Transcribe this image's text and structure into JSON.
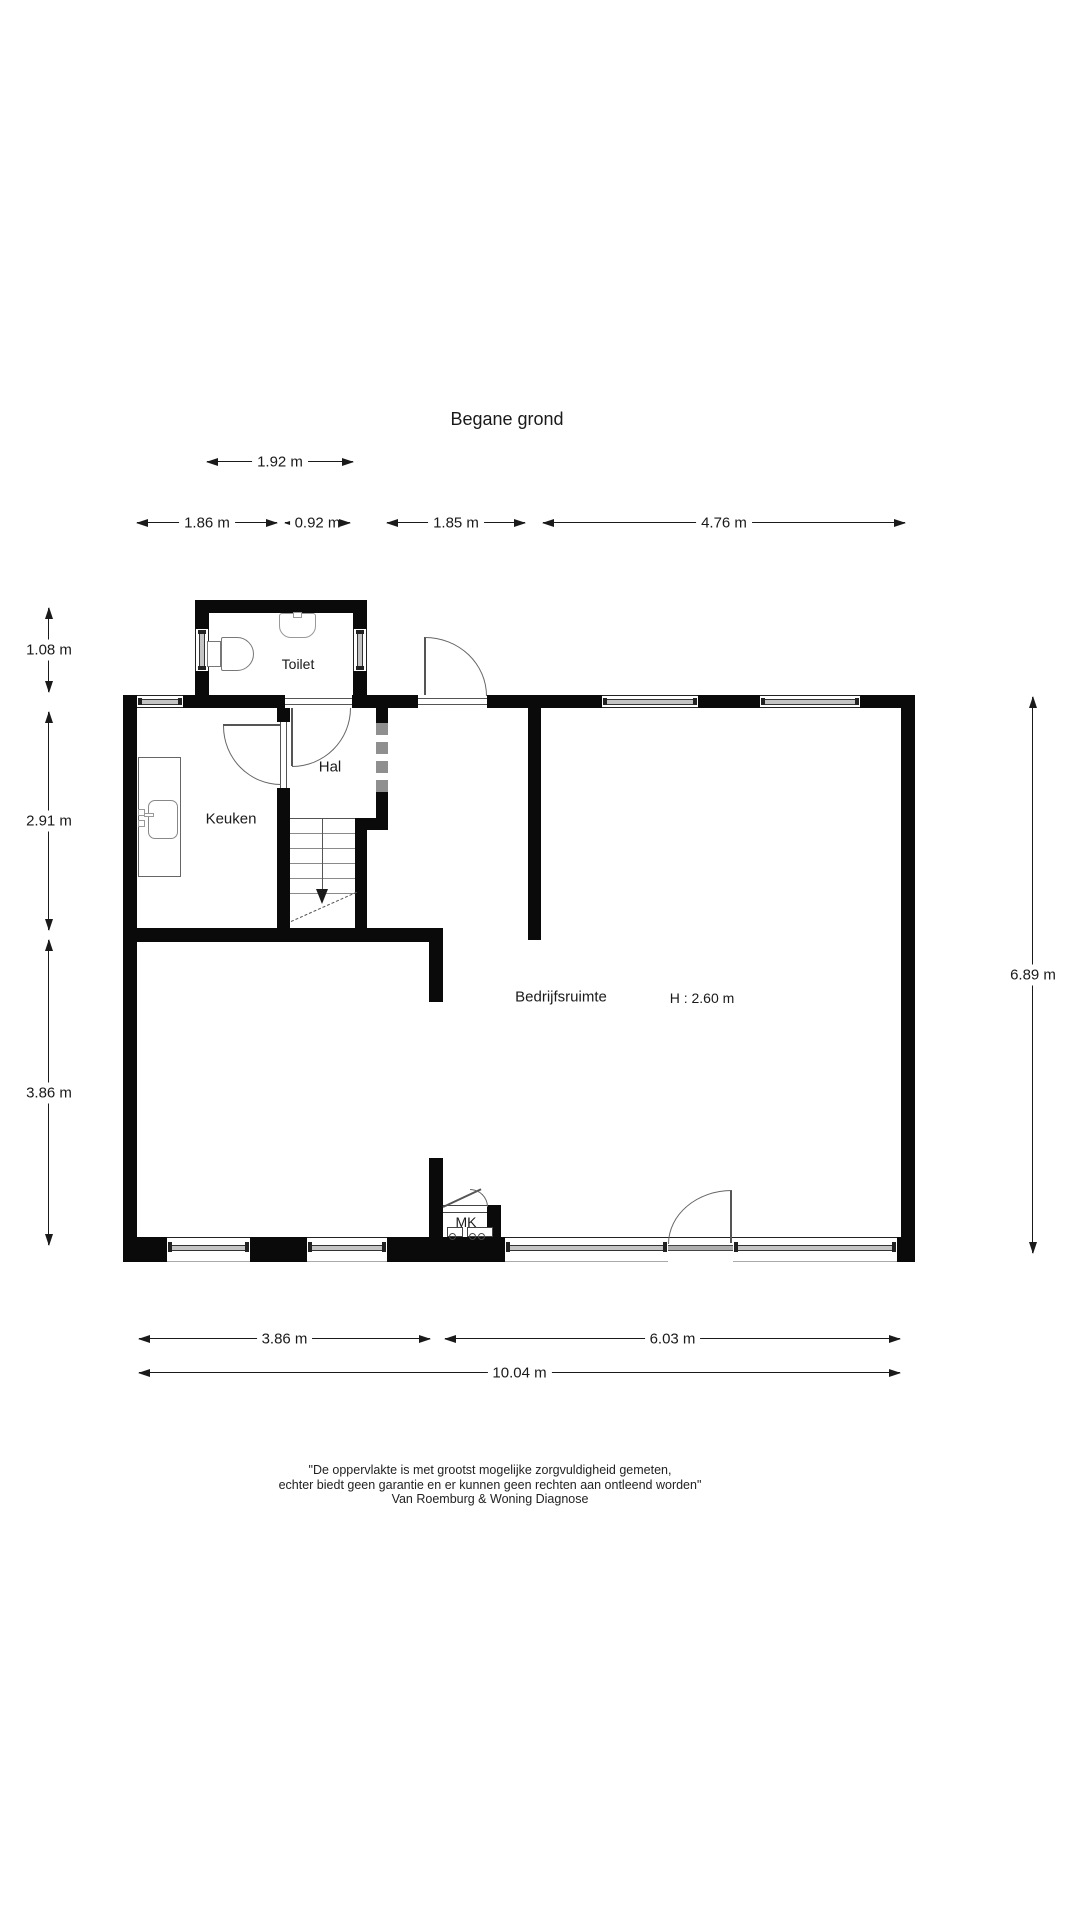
{
  "title": "Begane grond",
  "rooms": {
    "toilet": "Toilet",
    "hal": "Hal",
    "keuken": "Keuken",
    "bedrijfsruimte": "Bedrijfsruimte",
    "height_note": "H : 2.60 m",
    "mk": "MK"
  },
  "dimensions": {
    "toilet_width": "1.92 m",
    "keuken_width": "1.86 m",
    "hal_width": "0.92 m",
    "entry_width": "1.85 m",
    "front_right_width": "4.76 m",
    "toilet_depth": "1.08 m",
    "keuken_depth": "2.91 m",
    "lower_depth": "3.86 m",
    "total_depth": "6.89 m",
    "bottom_left_width": "3.86 m",
    "bottom_right_width": "6.03 m",
    "total_width": "10.04 m"
  },
  "footer": {
    "line1": "\"De oppervlakte is met grootst mogelijke zorgvuldigheid gemeten,",
    "line2": "echter biedt geen garantie en er kunnen geen rechten aan ontleend worden\"",
    "line3": "Van Roemburg & Woning Diagnose"
  },
  "colors": {
    "wall": "#0a0a0a",
    "thin_line": "#666666",
    "text": "#1a1a1a",
    "background": "#ffffff"
  }
}
